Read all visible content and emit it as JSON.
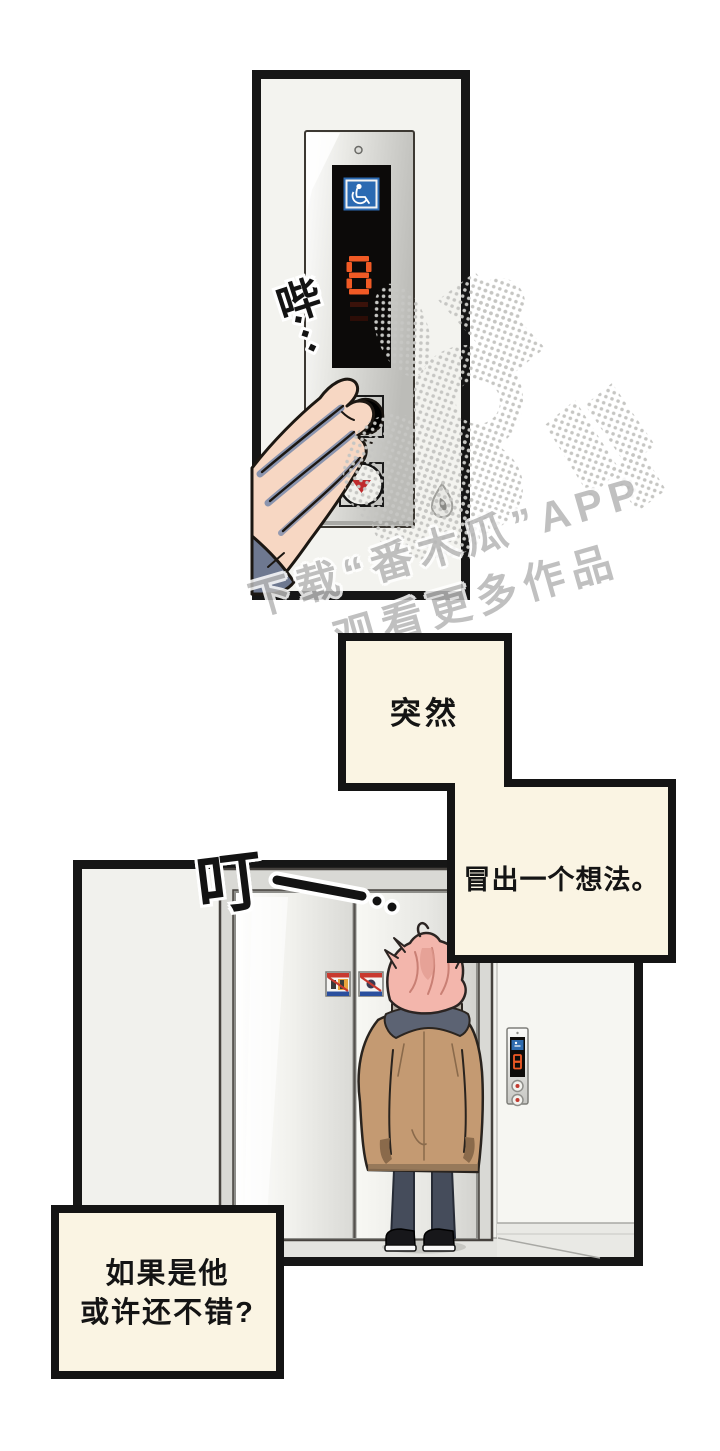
{
  "scene": {
    "type": "webtoon-comic-page",
    "background": "#ffffff",
    "panel1_label": "elevator button panel close-up with hand pressing button",
    "panel2_label": "hallway wide shot, person waiting in front of elevator"
  },
  "sfx": {
    "beep": "哔",
    "ding": "叮"
  },
  "captions": {
    "suddenly": "突然",
    "idea": "冒出一个想法。",
    "thought_line1": "如果是他",
    "thought_line2": "或许还不错?"
  },
  "watermark": {
    "line1": "下载“番木瓜”APP",
    "line2": "观看更多作品"
  },
  "elevator": {
    "display_floor": "8",
    "wall_panel_floor": "8",
    "direction_indicator": "down",
    "accessibility_icon": "wheelchair",
    "door_sign_icons": [
      "warning-sticker",
      "warning-sticker"
    ]
  },
  "colors": {
    "panel_bg": "#f3f3ef",
    "caption_box": "#faf4e3",
    "border": "#161616",
    "digit_orange": "#f15a25",
    "accessible_blue": "#2b6ab2",
    "arrow_red": "#bf2a2c",
    "coat_tan": "#c49a72",
    "hair_pink": "#f3b6ac",
    "scarf_gray": "#5c6373",
    "pants_gray": "#454c5b",
    "watermark_gray": "#b6b6b6"
  }
}
